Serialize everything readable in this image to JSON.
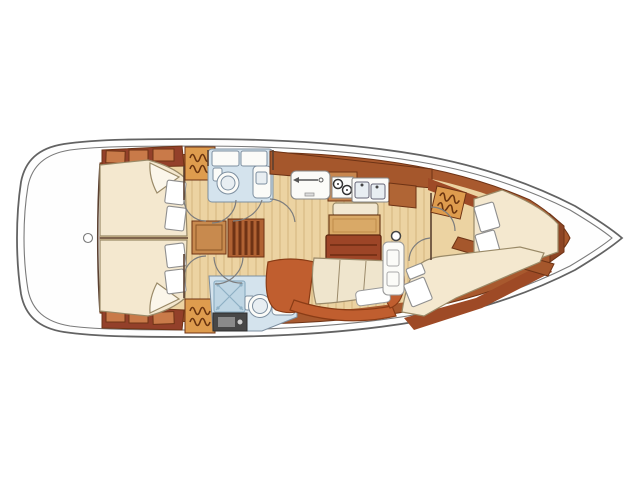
{
  "diagram": {
    "kind": "sailing-yacht-interior-floorplan",
    "orientation": {
      "bow": "right",
      "stern": "left"
    },
    "areas": [
      {
        "id": "stern-deck",
        "name": "stern deck"
      },
      {
        "id": "aft-cabin-port",
        "name": "aft double cabin (top)"
      },
      {
        "id": "aft-cabin-starboard",
        "name": "aft double cabin (bottom)"
      },
      {
        "id": "head-port",
        "name": "bathroom with toilet and sink (top)"
      },
      {
        "id": "head-starboard",
        "name": "bathroom with shower, toilet and sink (bottom)"
      },
      {
        "id": "companionway",
        "name": "companionway steps"
      },
      {
        "id": "galley",
        "name": "galley with fridge, stove and double sink"
      },
      {
        "id": "salon",
        "name": "salon with folding table and settees"
      },
      {
        "id": "chart-table",
        "name": "chart table"
      },
      {
        "id": "mast-post",
        "name": "mast compression post"
      },
      {
        "id": "forward-cabin-port",
        "name": "forward double cabin (upper)"
      },
      {
        "id": "forward-cabin-starboard",
        "name": "forward double cabin (lower)"
      },
      {
        "id": "bow-deck",
        "name": "bow"
      }
    ],
    "icons": [
      {
        "name": "hanger-icon",
        "meaning": "hanging locker / wardrobe"
      },
      {
        "name": "shower-icon",
        "meaning": "shower tray"
      },
      {
        "name": "burner-icon",
        "meaning": "stove burner"
      },
      {
        "name": "arrow-icon",
        "meaning": "fridge lid opening direction"
      }
    ]
  },
  "palette": {
    "white": "#ffffff",
    "paper": "#ffffff",
    "deck_white": "#fefefe",
    "wood_ring": "#a8592e",
    "trim_dark": "#9e4a26",
    "floor_tan": "#ecd3a2",
    "locker_dark": "#93402a",
    "locker_light": "#c97a49",
    "bed_cream": "#f4e8cf",
    "fold_white": "#fbf6ea",
    "pillow_white": "#ffffff",
    "wardrobe_orange": "#de9c4e",
    "bath_floor": "#d4e3ed",
    "shower_blue": "#bfd6e4",
    "fixture_white": "#fbfbf8",
    "sink_inner": "#e8eef2",
    "step_box": "#c88a4e",
    "steps_wood": "#b06233",
    "table_dark": "#9d4527",
    "table_leaf": "#d9a967",
    "bench_cream": "#f2e8d2",
    "settee_orange": "#c05e2f",
    "cushion_cream": "#efe5cd",
    "counter_wood": "#c8874f",
    "counter_wood2": "#b06535",
    "grate_dark": "#474747",
    "grate_mid": "#8a8a8a",
    "bulkhead_brown": "#8d4524",
    "divider_brown": "#a5572c"
  }
}
